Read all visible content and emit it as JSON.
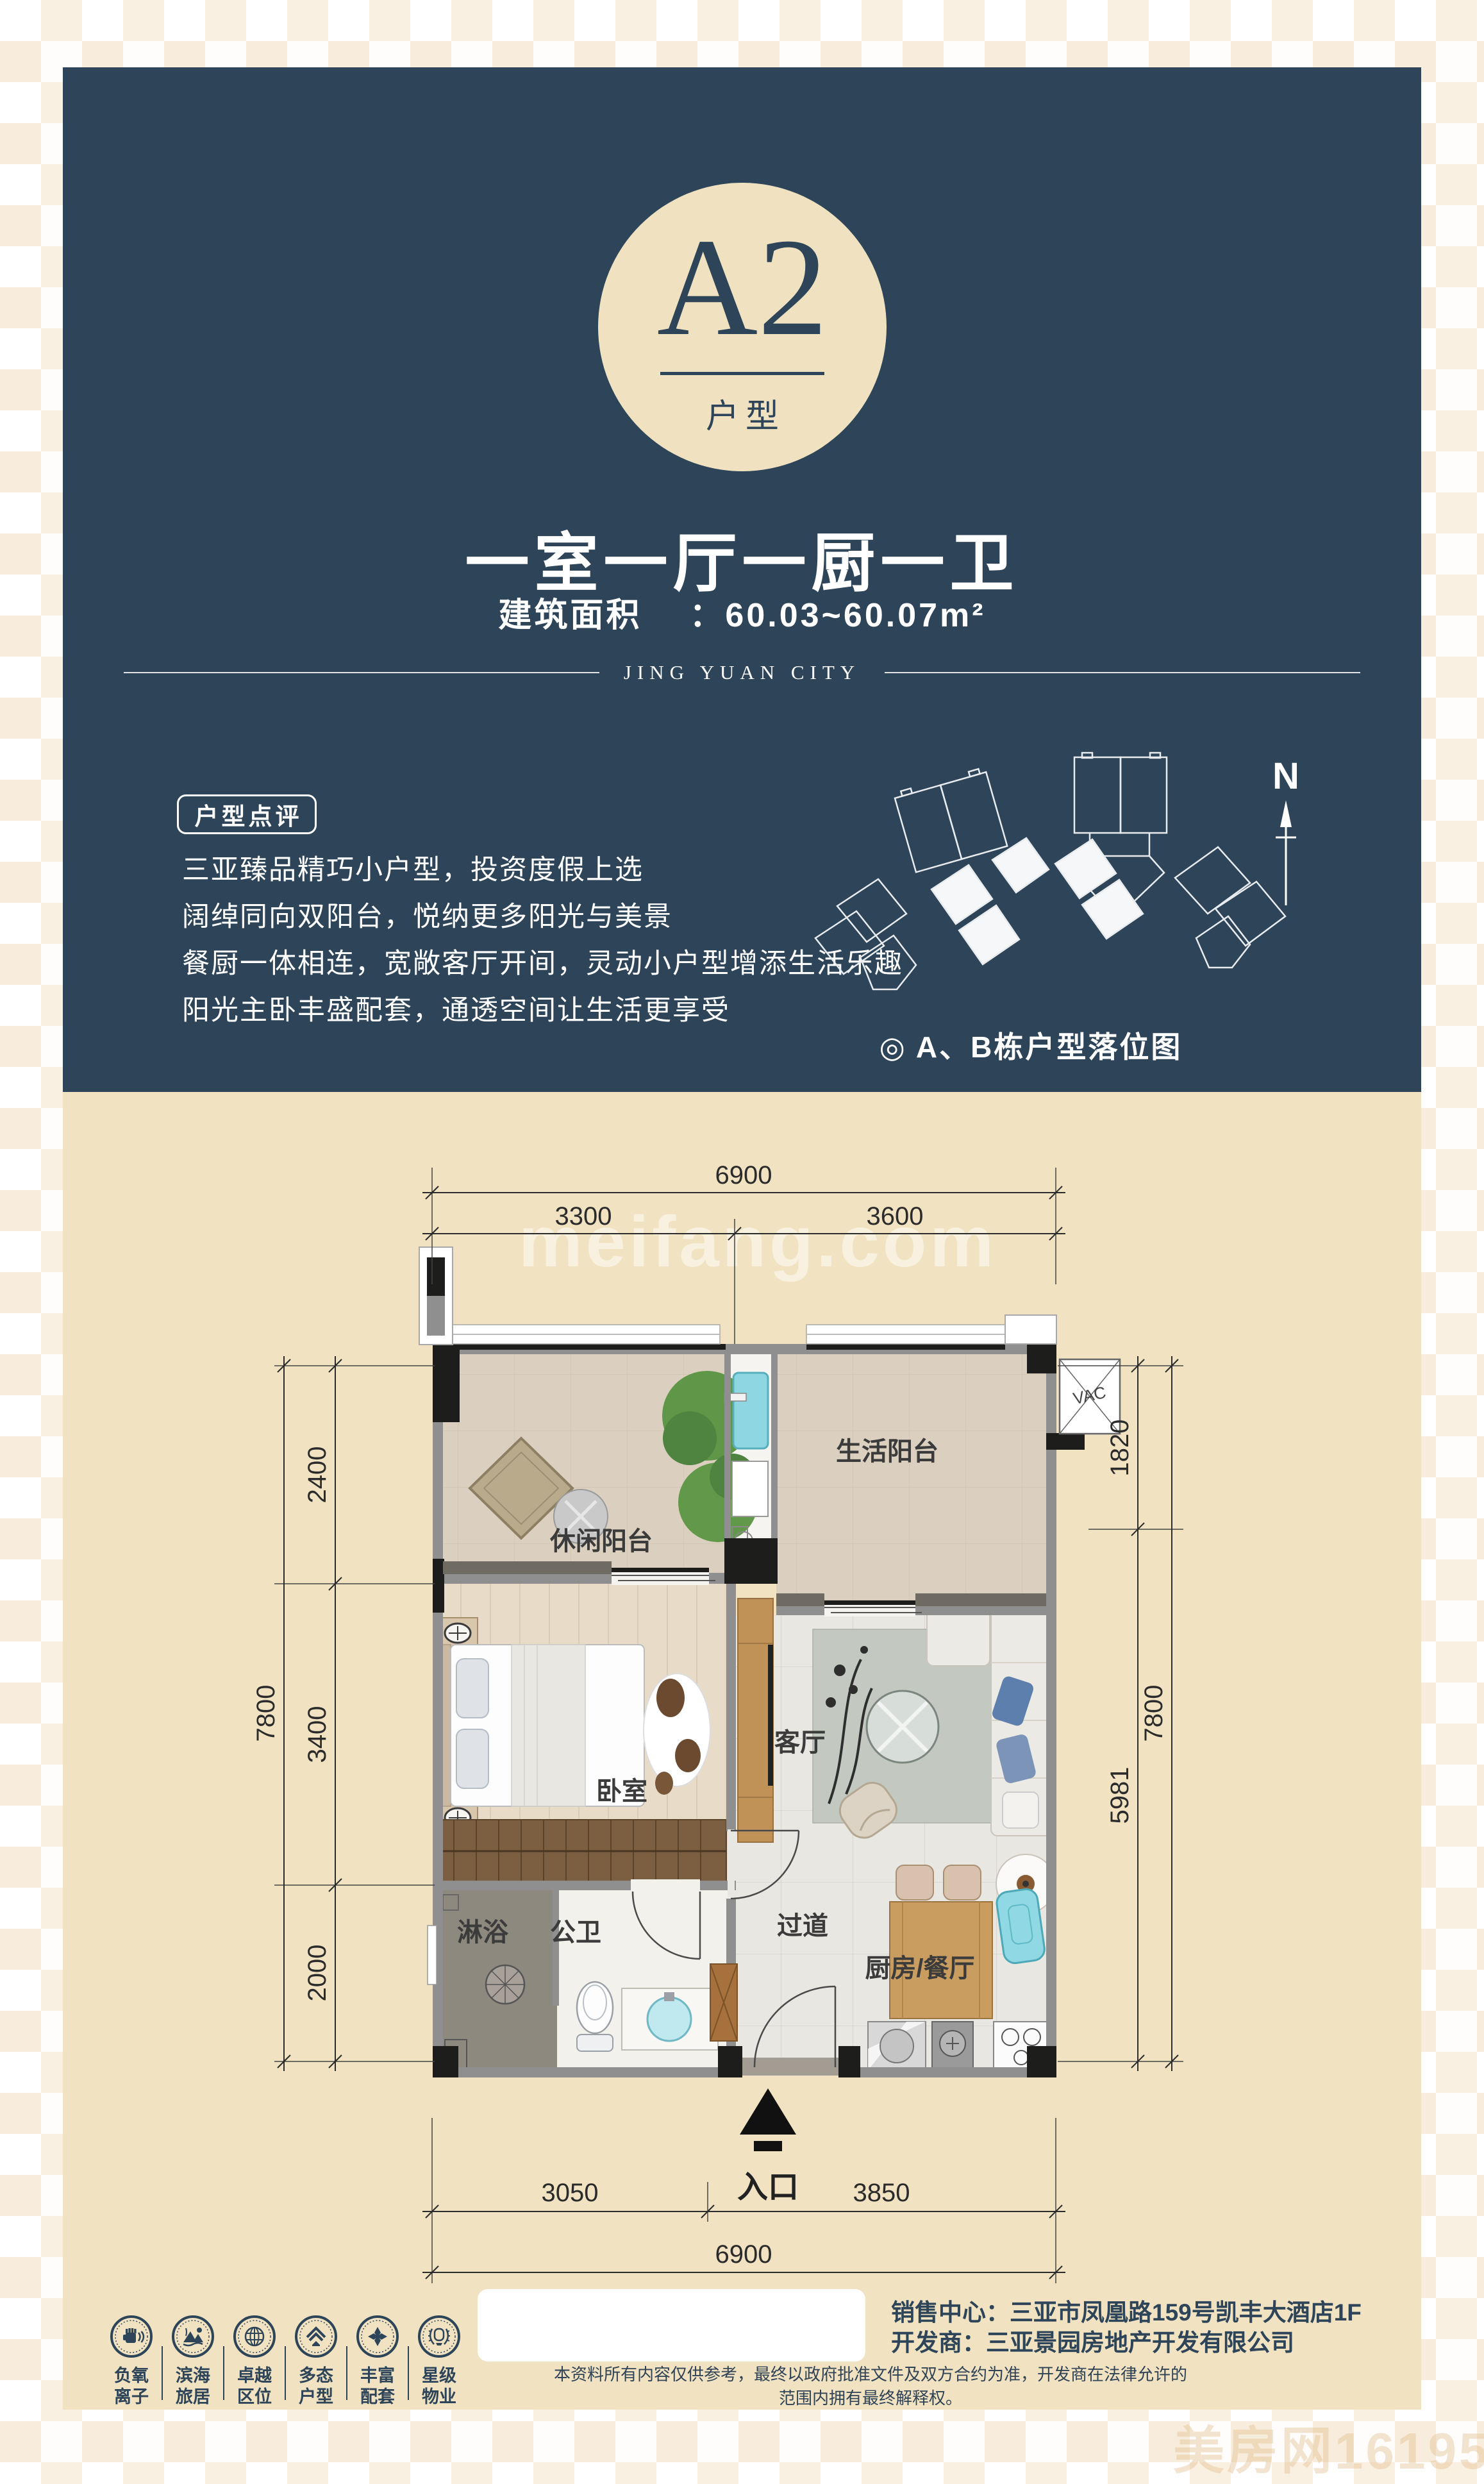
{
  "header": {
    "unit_code": "A2",
    "unit_code_label": "户型",
    "title": "一室一厅一厨一卫",
    "area_label": "建筑面积",
    "area_value": "：60.03~60.07m²",
    "brand": "JING YUAN CITY",
    "comment_box_label": "户型点评",
    "comments": [
      "三亚臻品精巧小户型，投资度假上选",
      "阔绰同向双阳台，悦纳更多阳光与美景",
      "餐厨一体相连，宽敞客厅开间，灵动小户型增添生活乐趣",
      "阳光主卧丰盛配套，通透空间让生活更享受"
    ],
    "siteplan_caption": "◎ A、B栋户型落位图",
    "compass_n": "N"
  },
  "floorplan": {
    "watermark": "meifang.com",
    "vac_label": "VAC",
    "entrance_label": "入口",
    "rooms": {
      "leisure_balcony": "休闲阳台",
      "life_balcony": "生活阳台",
      "bedroom": "卧室",
      "living": "客厅",
      "shower": "淋浴",
      "bath": "公卫",
      "corridor": "过道",
      "kitchen": "厨房/餐厅"
    },
    "dims": {
      "top_total": "6900",
      "top_left": "3300",
      "top_right": "3600",
      "left_total": "7800",
      "left_seg1": "2400",
      "left_seg2": "3400",
      "left_seg3": "2000",
      "right_seg1": "1820",
      "right_seg2": "5981",
      "right_total": "7800",
      "bottom_left": "3050",
      "bottom_right": "3850",
      "bottom_total": "6900"
    }
  },
  "footer": {
    "badges": [
      {
        "line1": "负氧",
        "line2": "离子"
      },
      {
        "line1": "滨海",
        "line2": "旅居"
      },
      {
        "line1": "卓越",
        "line2": "区位"
      },
      {
        "line1": "多态",
        "line2": "户型"
      },
      {
        "line1": "丰富",
        "line2": "配套"
      },
      {
        "line1": "星级",
        "line2": "物业"
      }
    ],
    "sales_center": "销售中心：三亚市凤凰路159号凯丰大酒店1F",
    "developer": "开发商：三亚景园房地产开发有限公司",
    "disclaimer": "本资料所有内容仅供参考，最终以政府批准文件及双方合约为准，开发商在法律允许的范围内拥有最终解释权。"
  },
  "corner_watermark": "美房网161955035",
  "colors": {
    "navy": "#2d4459",
    "cream": "#f1e3c2",
    "badge_cream": "#f0e2c1",
    "wall_gray": "#8f8f8f",
    "structure_black": "#1d1d1b"
  }
}
